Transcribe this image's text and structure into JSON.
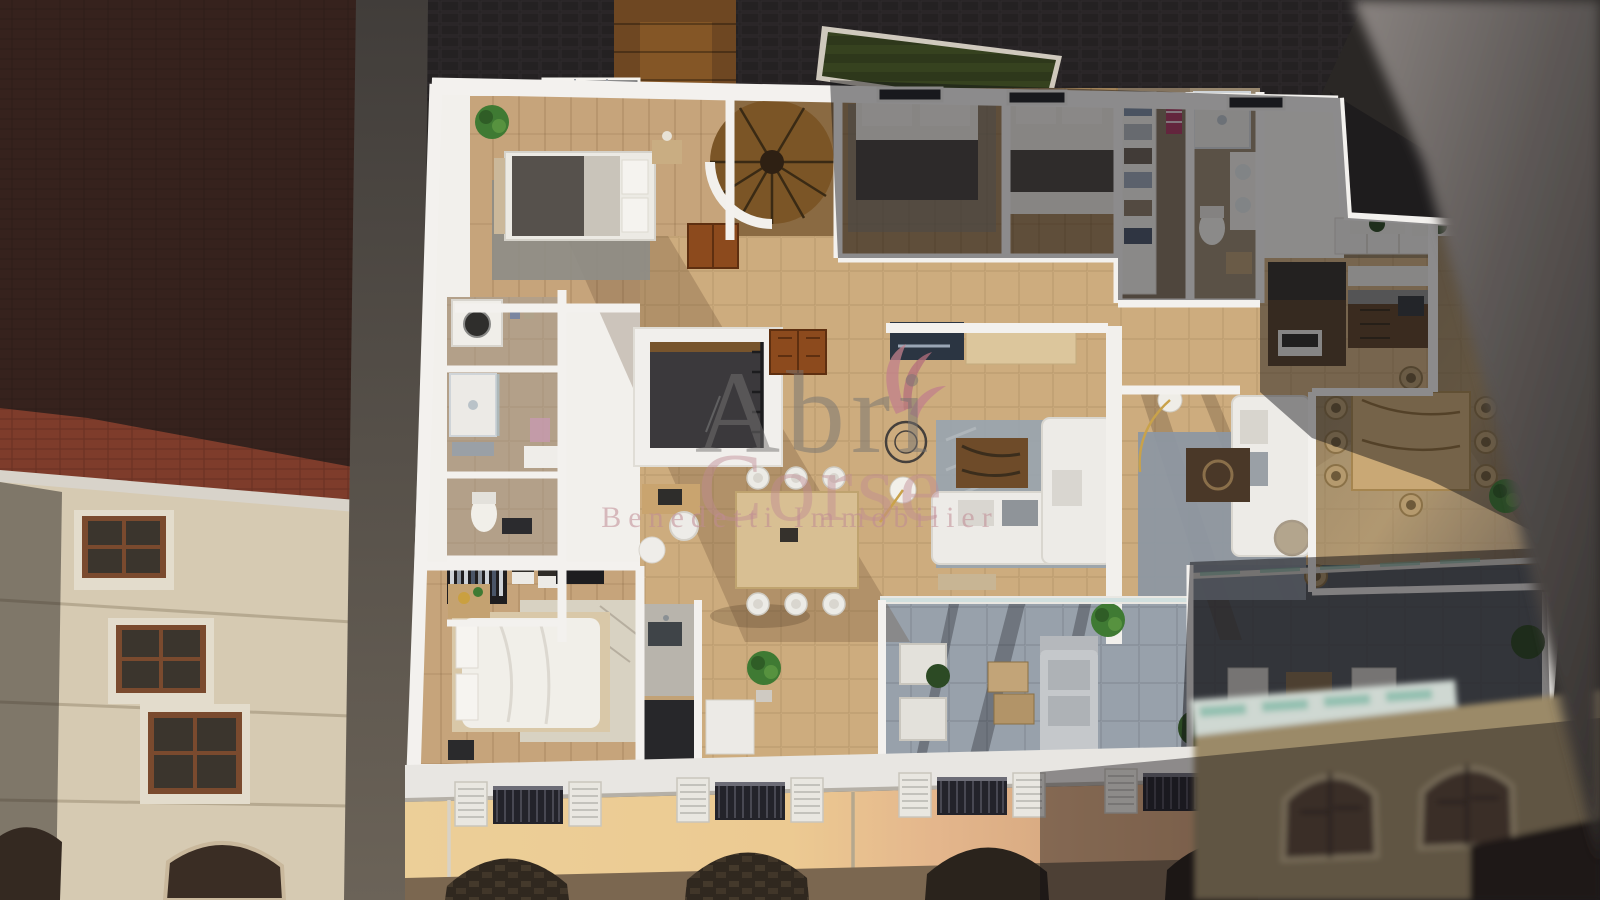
{
  "watermark": {
    "title_line1": "Abri",
    "title_line2": "Corse",
    "subtitle": "Benedetti Immobilier",
    "title_color": "#757372",
    "accent_color": "#c08b94"
  },
  "palette": {
    "courtyard": "#242122",
    "deck_wood": "#6e4722",
    "lawn": "#36421f",
    "roof_dark": "#36221d",
    "roof_red": "#7e3c2b",
    "left_facade": "#d6cab2",
    "window_frame": "#7a4a2e",
    "wall_white": "#f2f0ec",
    "wood_floor": "#c6a47b",
    "wood_floor_shaded": "#a08259",
    "tile_floor": "#cdac7e",
    "terrace_tile": "#98a1ab",
    "terrace_dark": "#575d63",
    "rug_gray": "#9aa4ae",
    "sofa_white": "#edebe7",
    "kitchen_wood": "#5d4329",
    "street_wall_yellow": "#ecd096",
    "street_wall_salmon": "#e0b189",
    "arch_wall": "#7b6750",
    "arch_dark": "#30281f",
    "neighbor_wall": "#5a5553",
    "glass_teal": "#7fb8a4",
    "plant_green": "#3f7a33",
    "plant_dark": "#2c4a24",
    "door_brown": "#8c4a1d",
    "railing_iron": "#23232a"
  }
}
